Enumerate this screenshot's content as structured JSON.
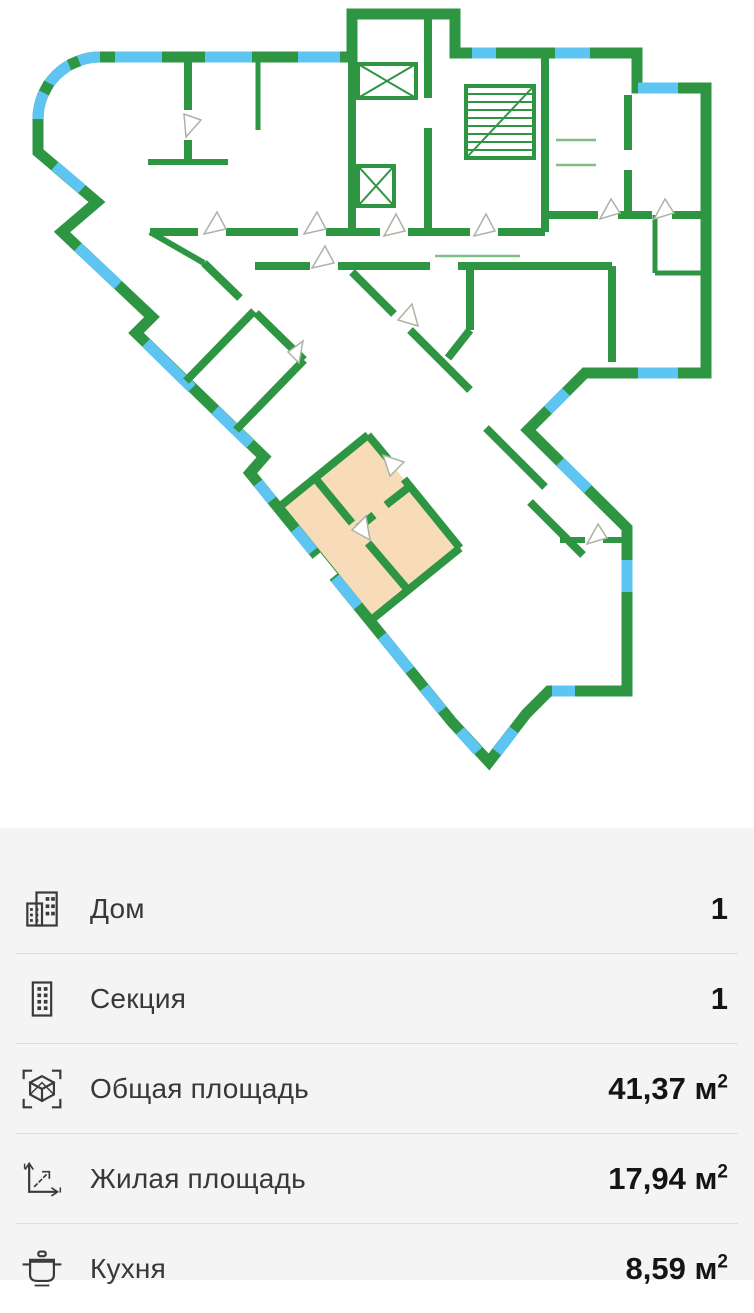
{
  "colors": {
    "wall": "#2e9642",
    "window": "#5ec4f2",
    "highlight": "#f8dcba",
    "door_line": "#a9b4a6",
    "panel_bg": "#f4f4f5",
    "divider": "#dddddd",
    "label_color": "#383838",
    "value_color": "#141414"
  },
  "plan": {
    "description": "floor-plan",
    "highlighted_apartment": "selected-apartment"
  },
  "info": {
    "rows": [
      {
        "id": "house",
        "label": "Дом",
        "value": "1",
        "sup": ""
      },
      {
        "id": "section",
        "label": "Секция",
        "value": "1",
        "sup": ""
      },
      {
        "id": "total_area",
        "label": "Общая площадь",
        "value": "41,37 м",
        "sup": "2"
      },
      {
        "id": "living_area",
        "label": "Жилая площадь",
        "value": "17,94 м",
        "sup": "2"
      },
      {
        "id": "kitchen",
        "label": "Кухня",
        "value": "8,59 м",
        "sup": "2"
      }
    ]
  }
}
